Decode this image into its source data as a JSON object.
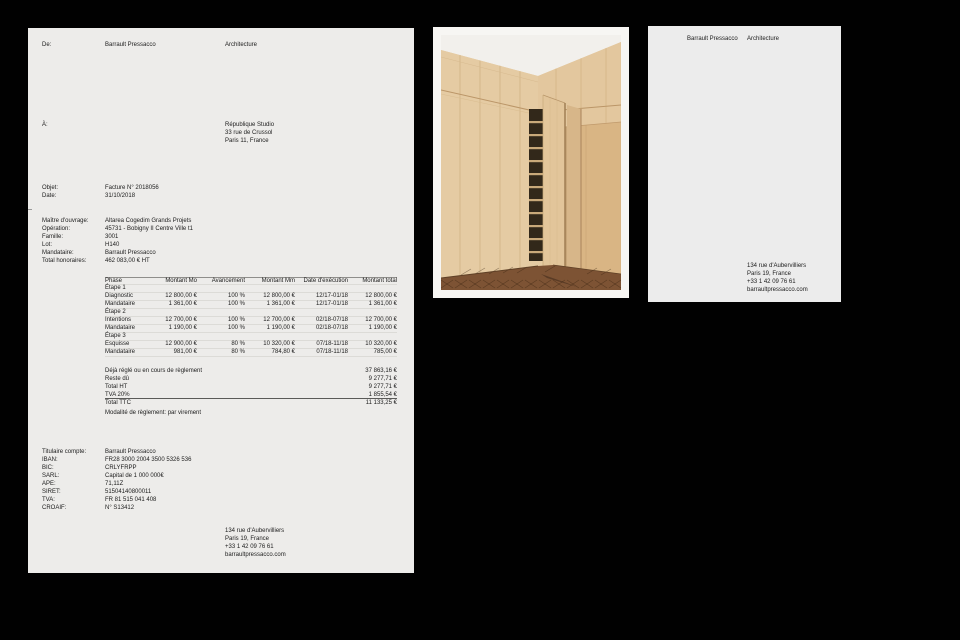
{
  "canvas": {
    "background": "#010101"
  },
  "invoice_page": {
    "background": "#edecea",
    "from": {
      "label": "De:",
      "name": "Barrault Pressacco",
      "dept": "Architecture"
    },
    "to": {
      "label": "À:",
      "lines": [
        "République Studio",
        "33 rue de Crussol",
        "Paris 11, France"
      ]
    },
    "meta": {
      "rows": [
        {
          "label": "Objet:",
          "value": "Facture N° 2018056"
        },
        {
          "label": "Date:",
          "value": "31/10/2018"
        }
      ]
    },
    "project": {
      "rows": [
        {
          "label": "Maître d'ouvrage:",
          "value": "Altarea Cogedim Grands Projets"
        },
        {
          "label": "Opération:",
          "value": "45731 - Bobigny II Centre Ville t1"
        },
        {
          "label": "Famille:",
          "value": "3001"
        },
        {
          "label": "Lot:",
          "value": "H140"
        },
        {
          "label": "Mandataire:",
          "value": "Barrault Pressacco"
        },
        {
          "label": "Total honoraires:",
          "value": "462 083,00 € HT"
        }
      ]
    },
    "table": {
      "headers": {
        "phase": "Phase",
        "mo": "Montant Mo",
        "av": "Avancement",
        "mm": "Montant Mm",
        "date": "Date d'exécution",
        "total": "Montant total"
      },
      "rows": [
        {
          "phase": "Étape 1",
          "mo": "",
          "av": "",
          "mm": "",
          "date": "",
          "total": ""
        },
        {
          "phase": "Diagnostic",
          "mo": "12 800,00 €",
          "av": "100 %",
          "mm": "12 800,00 €",
          "date": "12/17-01/18",
          "total": "12 800,00 €"
        },
        {
          "phase": "Mandataire",
          "mo": "1 361,00 €",
          "av": "100 %",
          "mm": "1 361,00 €",
          "date": "12/17-01/18",
          "total": "1 361,00 €"
        },
        {
          "phase": "Étape 2",
          "mo": "",
          "av": "",
          "mm": "",
          "date": "",
          "total": ""
        },
        {
          "phase": "Intentions",
          "mo": "12 700,00 €",
          "av": "100 %",
          "mm": "12 700,00 €",
          "date": "02/18-07/18",
          "total": "12 700,00 €"
        },
        {
          "phase": "Mandataire",
          "mo": "1 190,00 €",
          "av": "100 %",
          "mm": "1 190,00 €",
          "date": "02/18-07/18",
          "total": "1 190,00 €"
        },
        {
          "phase": "Étape 3",
          "mo": "",
          "av": "",
          "mm": "",
          "date": "",
          "total": ""
        },
        {
          "phase": "Esquisse",
          "mo": "12 900,00 €",
          "av": "80 %",
          "mm": "10 320,00 €",
          "date": "07/18-11/18",
          "total": "10 320,00 €"
        },
        {
          "phase": "Mandataire",
          "mo": "981,00 €",
          "av": "80 %",
          "mm": "784,80 €",
          "date": "07/18-11/18",
          "total": "785,00 €"
        }
      ]
    },
    "totals": {
      "rows": [
        {
          "label": "Déjà réglé ou en cours de règlement",
          "value": "37 863,16 €"
        },
        {
          "label": "Reste dû",
          "value": "9 277,71 €"
        },
        {
          "label": "Total HT",
          "value": "9 277,71 €"
        },
        {
          "label": "TVA 20%",
          "value": "1 855,54 €"
        },
        {
          "label": "Total TTC",
          "value": "11 133,25 €"
        }
      ]
    },
    "payment_note": "Modalité de règlement: par virement",
    "bank": {
      "rows": [
        {
          "label": "Titulaire compte:",
          "value": "Barrault Pressacco"
        },
        {
          "label": "IBAN:",
          "value": "FR28 3000 2004 3500 5326 536"
        },
        {
          "label": "BIC:",
          "value": "CRLYFRPP"
        },
        {
          "label": "SARL:",
          "value": "Capital de 1 000 000€"
        },
        {
          "label": "APE:",
          "value": "71,11Z"
        },
        {
          "label": "SIRET:",
          "value": "51504140800011"
        },
        {
          "label": "TVA:",
          "value": "FR 81 515 041 408"
        },
        {
          "label": "CROAIF:",
          "value": "N° S13412"
        }
      ]
    },
    "footer": {
      "lines": [
        "134 rue d'Aubervilliers",
        "Paris 19, France",
        "+33 1 42 09 76 61",
        "barraultpressacco.com"
      ]
    }
  },
  "photo_panel": {
    "background": "#f7f6f3",
    "photo": {
      "description": "wardrobe-interior-photo",
      "wood": "#e5cba3",
      "wood_right": "#e3c79e",
      "alcove": "#d9b584",
      "door": "#e2c59a",
      "return_panel": "#d7b689",
      "ceiling": "#f2f0ec",
      "floor": "#7d5334",
      "shelf_dark": "#32281a",
      "shelf_light": "#c9a97a"
    }
  },
  "letterhead_page": {
    "background": "#ececec",
    "name": "Barrault Pressacco",
    "dept": "Architecture",
    "address": {
      "lines": [
        "134 rue d'Aubervilliers",
        "Paris 19, France",
        "+33 1 42 09 76 61",
        "barraultpressacco.com"
      ]
    }
  }
}
